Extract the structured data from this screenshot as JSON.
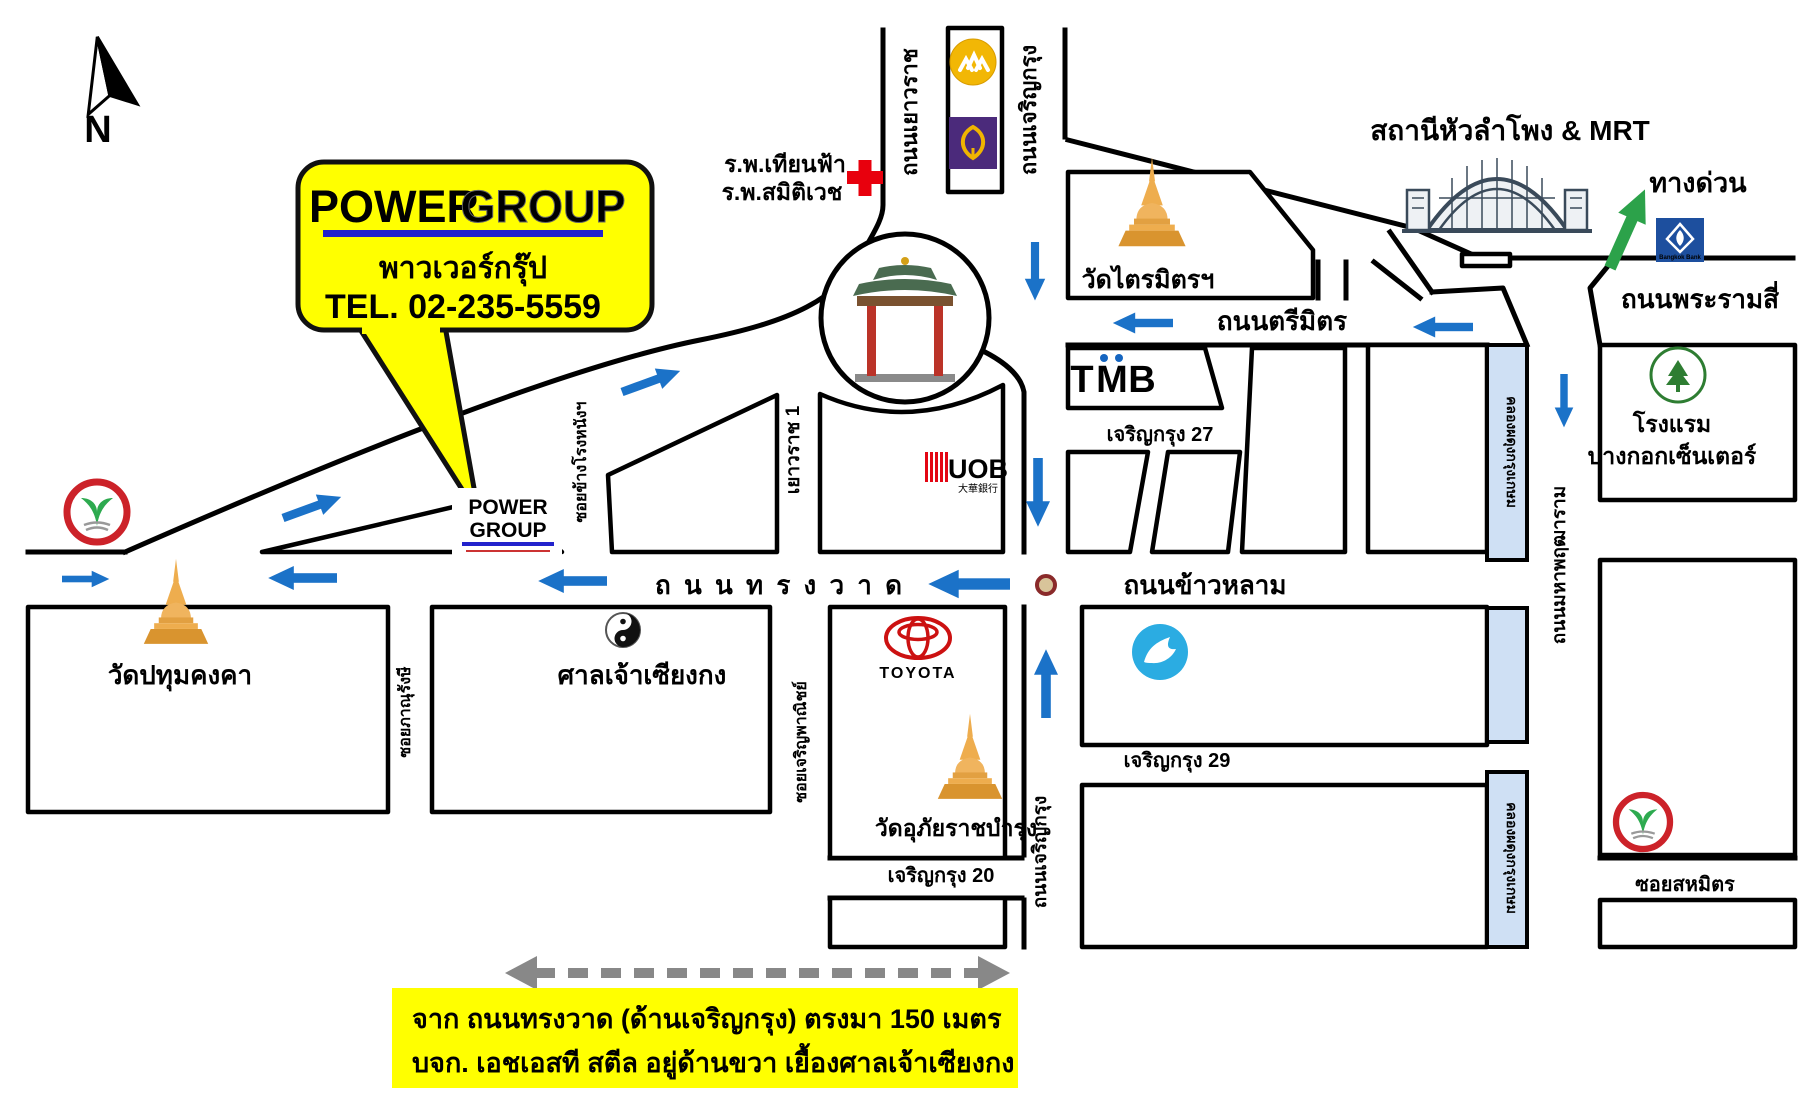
{
  "map": {
    "compass": {
      "label": "N"
    },
    "callout": {
      "power": "POWER",
      "group": "GROUP",
      "thai_name": "พาวเวอร์กรุ๊ป",
      "tel": "TEL. 02-235-5559"
    },
    "site_label": {
      "power": "POWER",
      "group": "GROUP"
    },
    "roads": {
      "yaowarat": "ถนนเยาวราช",
      "charoen_krung": "ถนนเจริญกรุง",
      "yaowarat1": "เยาวราช 1",
      "soi_khang_rong_nang": "ซอยข้างโรงหนังฯ",
      "soi_phanurangsi": "ซอยภาณุรังษี",
      "soi_charoen_phanich": "ซอยเจริญพาณิชย์",
      "trimit": "ถนนตรีมิตร",
      "songwat": "ถ น น ท ร ง ว า ด",
      "khao_lam": "ถนนข้าวหลาม",
      "rama4": "ถนนพระรามสี่",
      "maha_phruettharam": "ถนนมหาพฤฒาราม",
      "charoen_krung27": "เจริญกรุง 27",
      "charoen_krung29": "เจริญกรุง 29",
      "charoen_krung20": "เจริญกรุง 20",
      "soi_sahamit": "ซอยสหมิตร",
      "canal": "คลองผดุงกรุงเกษม",
      "expressway": "ทางด่วน"
    },
    "places": {
      "hospital_line1": "ร.พ.เทียนฟ้า",
      "hospital_line2": "ร.พ.สมิติเวช",
      "wat_traimit": "วัดไตรมิตรฯ",
      "station": "สถานีหัวลำโพง & MRT",
      "wat_pathum": "วัดปทุมคงคา",
      "shrine": "ศาลเจ้าเซียงกง",
      "wat_uphai": "วัดอุภัยราชบำรุง",
      "hotel_line1": "โรงแรม",
      "hotel_line2": "บางกอกเซ็นเตอร์",
      "toyota": "TOYOTA",
      "tmb": {
        "t": "T",
        "m": "M",
        "b": "B"
      },
      "uob": {
        "name": "UOB",
        "cn": "大華銀行"
      },
      "bangkok_bank": "Bangkok Bank"
    },
    "note": {
      "line1": "จาก ถนนทรงวาด (ด้านเจริญกรุง)  ตรงมา 150 เมตร",
      "line2": "บจก. เอชเอสที สตีล อยู่ด้านขวา    เยื้องศาลเจ้าเซียงกง"
    },
    "colors": {
      "highlight": "#ffff00",
      "arrow_blue": "#1b72c8",
      "arrow_green": "#2ca24a",
      "canal_fill": "#cfe0f4",
      "brand_blue": "#2222cc",
      "brand_gray": "#a0a0a0"
    }
  }
}
